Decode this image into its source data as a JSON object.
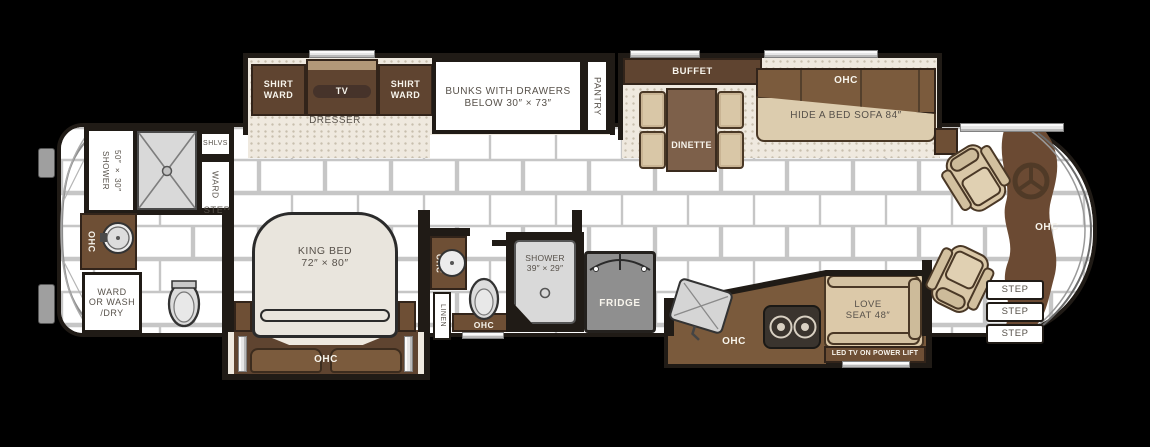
{
  "palette": {
    "wall": "#201b16",
    "cabinet_dark": "#5f4430",
    "cabinet": "#6e4f35",
    "cabinet_mid": "#7b5b3d",
    "wood_light": "#b29878",
    "upholstery_tan": "#d9c7a7",
    "floor_dot": "#efe9df",
    "tile_grout": "#c6c6c6",
    "appliance_gray": "#8f8f8f",
    "label_dark": "#57514a",
    "label_light": "#f7f4ec"
  },
  "icons": {
    "steering_wheel": "ring-with-spokes",
    "sink": "circle-basin",
    "toilet": "oval-bowl",
    "shower_drain": "small-circle",
    "cooktop": "two-burner-rings",
    "shower_pan": "x-cross-pan",
    "fridge_doors": "double-door-arcs"
  },
  "bedroom_slide": {
    "shirt_ward_left": "SHIRT WARD",
    "tv": "TV",
    "shirt_ward_right": "SHIRT WARD",
    "dresser": "DRESSER",
    "bunks_line1": "BUNKS WITH DRAWERS",
    "bunks_line2": "BELOW 30″ × 73″",
    "pantry": "PANTRY"
  },
  "living_slide": {
    "buffet": "BUFFET",
    "buffet_ohc": "OHC",
    "dinette": "DINETTE",
    "sofa_ohc": "OHC",
    "hide_a_bed": "HIDE A BED SOFA 84″"
  },
  "rear_bath": {
    "shower_size": "50″ × 30″",
    "shower_word": "SHOWER",
    "shlvs": "SHLVS",
    "ward": "WARD",
    "step": "STEP",
    "vanity_ohc": "OHC",
    "wardwash_line1": "WARD",
    "wardwash_line2": "OR WASH",
    "wardwash_line3": "/DRY"
  },
  "bedroom": {
    "king_bed_line1": "KING BED",
    "king_bed_line2": "72″ × 80″",
    "ohc": "OHC"
  },
  "mid_bath": {
    "ohc_sink": "OHC",
    "linen": "LINEN",
    "ohc_toilet": "OHC",
    "shower_line1": "SHOWER",
    "shower_line2": "39″ × 29″"
  },
  "kitchen": {
    "fridge": "FRIDGE",
    "ohc": "OHC"
  },
  "living_room": {
    "loveseat_line1": "LOVE",
    "loveseat_line2": "SEAT 48″",
    "led_tv": "LED TV ON POWER LIFT"
  },
  "cockpit": {
    "dash_ohc": "OHC",
    "steps": [
      "STEP",
      "STEP",
      "STEP"
    ]
  }
}
